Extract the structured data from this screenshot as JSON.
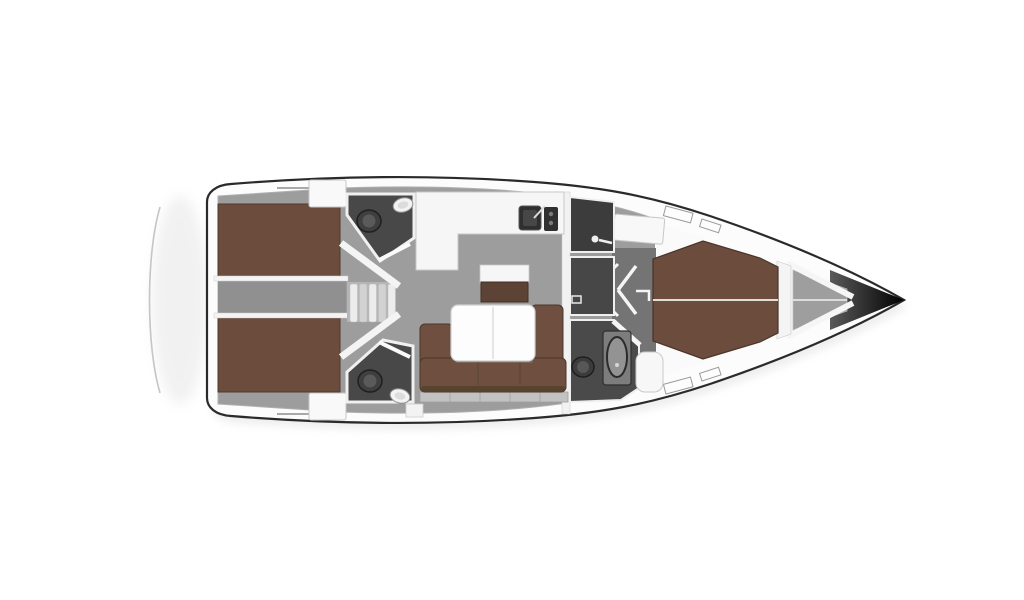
{
  "image": {
    "title": "Sailing yacht interior floor plan — top-down view",
    "type": "boat-floor-plan"
  },
  "colors": {
    "background": "#ffffff",
    "hull_fill": "#fcfcfc",
    "hull_outline": "#2a2a2a",
    "floor_gray": "#9d9d9d",
    "engine_gray": "#909090",
    "corridor_gray": "#747474",
    "locker_gray": "#9e9e9e",
    "head_floor": "#484848",
    "shower_floor": "#3c3c3c",
    "wc_floor": "#474747",
    "fwd_head_floor": "#4a4a4a",
    "berth_brown": "#6b4c3d",
    "sofa_brown": "#6f5040",
    "sofa_front": "#55402f",
    "cabinet_brown": "#5d4335",
    "furniture_white": "#f6f6f6",
    "table_white": "#fdfdfd",
    "fixture_dark": "#3c3c3c",
    "fixture_mid": "#5a5a5a",
    "vanity_gray": "#7d7d7d",
    "basin_gray": "#939393",
    "stair_light": "#ececec",
    "stair_dark": "#d2d2d2",
    "trim_gray": "#c2c2c2",
    "wall_white": "#f4f4f4",
    "bow_mid": "#5a5a5a",
    "bow_dark": "#000000",
    "platform_line": "#c5c5c5",
    "shadow": "#9a9a9a"
  },
  "rooms": {
    "aft_cabin_port": "Aft double cabin (port)",
    "aft_cabin_starboard": "Aft double cabin (starboard)",
    "aft_head_port": "Aft head with WC and basin (port)",
    "aft_head_starboard": "Aft head with WC and basin (starboard)",
    "engine_compartment": "Engine compartment",
    "companionway": "Companionway steps",
    "galley": "L-shaped galley with sink and stove",
    "salon": "Salon with U-shaped settee and folding table",
    "forward_head_shower": "Forward shower room",
    "forward_head_wc": "Forward WC room",
    "forward_head_starboard": "Forward head with basin and WC",
    "forward_cabin": "Forward V-berth cabin",
    "anchor_locker": "Anchor locker",
    "swim_platform": "Transom swim platform"
  }
}
